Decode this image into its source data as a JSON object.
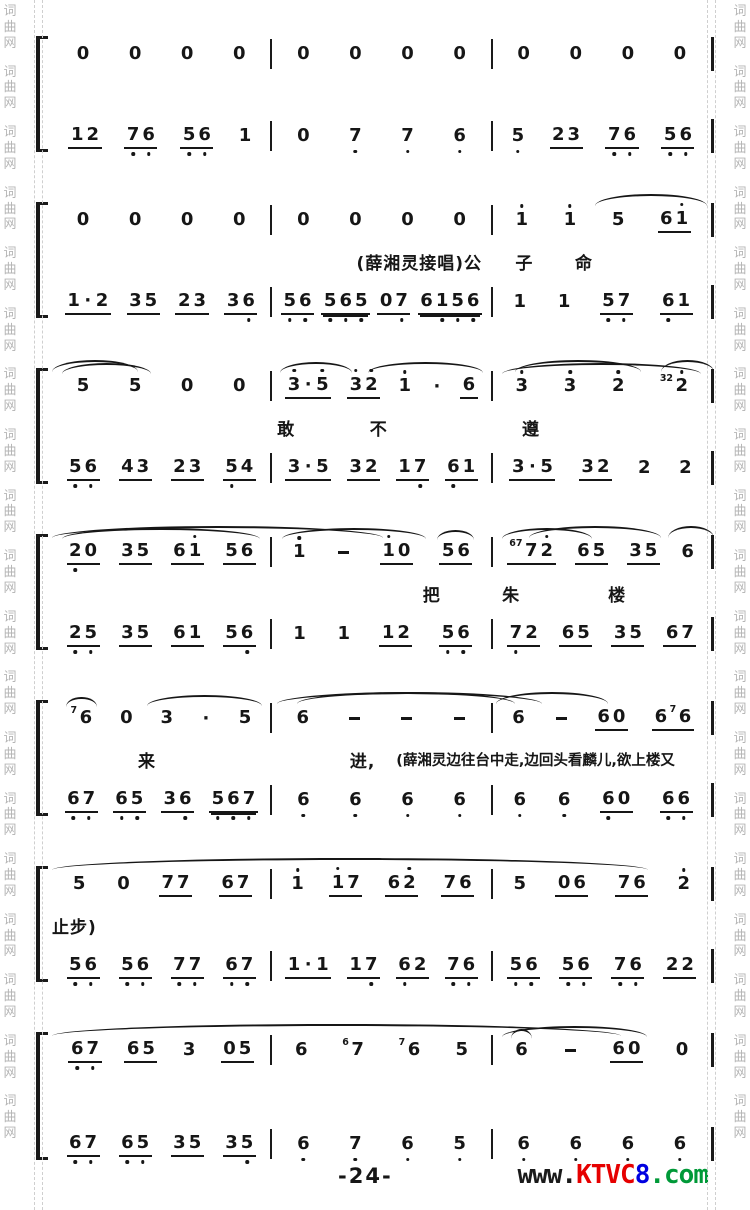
{
  "watermark": {
    "chars": [
      "词",
      "曲",
      "网"
    ],
    "color": "#b5b5b5"
  },
  "footer": {
    "page_number": "-24-",
    "logo_prefix": "www.",
    "logo_brand": "KTVC",
    "logo_digit": "8",
    "logo_suffix": ".com",
    "logo_colors": {
      "prefix": "#1a1a1a",
      "brand": "#e60000",
      "digit": "#0000e0",
      "suffix": "#009938"
    }
  },
  "score": {
    "ink": "#161616",
    "systems": [
      {
        "upper": {
          "ms": [
            {
              "u": [
                "0",
                "0",
                "0",
                "0"
              ]
            },
            {
              "u": [
                "0",
                "0",
                "0",
                "0"
              ]
            },
            {
              "u": [
                "0",
                "0",
                "0",
                "0"
              ]
            }
          ]
        },
        "lyrics": [],
        "lower": {
          "ms": [
            {
              "u": [
                "12/1",
                "7,6,/1",
                "5,6,/1",
                "1"
              ]
            },
            {
              "u": [
                "0",
                "7,",
                "7,",
                "6,"
              ]
            },
            {
              "u": [
                "5,",
                "23/1",
                "7,6,/1",
                "5,6,/1"
              ]
            }
          ]
        }
      },
      {
        "upper": {
          "arcs": [
            {
              "l": "82%",
              "w": "17%"
            }
          ],
          "ms": [
            {
              "u": [
                "0",
                "0",
                "0",
                "0"
              ]
            },
            {
              "u": [
                "0",
                "0",
                "0",
                "0"
              ]
            },
            {
              "u": [
                "1'",
                "1'",
                "5",
                "61'/1"
              ]
            }
          ]
        },
        "lyrics": [
          {
            "t": "(薛湘灵接唱)公",
            "l": "46%"
          },
          {
            "t": "子",
            "l": "70%"
          },
          {
            "t": "命",
            "l": "79%"
          }
        ],
        "lower": {
          "ms": [
            {
              "u": [
                "1.2/1",
                "35/1",
                "23/1",
                "36,/1"
              ]
            },
            {
              "u": [
                "5,6,/1",
                "5,6,5,/2",
                "07,/1",
                "61,5,6,/2"
              ]
            },
            {
              "u": [
                "1",
                "1",
                "5,7,/1",
                "6,1/1"
              ]
            }
          ]
        }
      },
      {
        "upper": {
          "arcs": [
            {
              "l": "0%",
              "w": "13%"
            },
            {
              "l": "70%",
              "w": "19%"
            },
            {
              "l": "92%",
              "w": "8%"
            }
          ],
          "ms": [
            {
              "u": [
                "5",
                "5",
                "0",
                "0"
              ],
              "slurs": [
                [
                  0,
                  1
                ]
              ]
            },
            {
              "u": [
                "3'.5'/1",
                "3'2'/1",
                "1'",
                ".",
                "6/1"
              ],
              "slurs": [
                [
                  0,
                  1
                ],
                [
                  2,
                  4
                ]
              ]
            },
            {
              "u": [
                "3'",
                "3'",
                "2'",
                "(32)2'"
              ],
              "slurs": [
                [
                  0,
                  3
                ]
              ]
            }
          ]
        },
        "lyrics": [
          {
            "t": "敢",
            "l": "34%"
          },
          {
            "t": "不",
            "l": "48%"
          },
          {
            "t": "遵",
            "l": "71%"
          }
        ],
        "lower": {
          "ms": [
            {
              "u": [
                "5,6,/1",
                "43/1",
                "23/1",
                "5,4/1"
              ]
            },
            {
              "u": [
                "3.5/1",
                "32/1",
                "17,/1",
                "6,1/1"
              ]
            },
            {
              "u": [
                "3.5/1",
                "32/1",
                "2",
                "2"
              ]
            }
          ]
        }
      },
      {
        "upper": {
          "arcs": [
            {
              "l": "0%",
              "w": "50%"
            },
            {
              "l": "72%",
              "w": "20%"
            },
            {
              "l": "93%",
              "w": "7%"
            }
          ],
          "ms": [
            {
              "u": [
                "2,0/1",
                "35/1",
                "61'/1",
                "56/1"
              ],
              "slurs": [
                [
                  0,
                  3
                ]
              ]
            },
            {
              "u": [
                "1'",
                "-",
                "1'0/1",
                "~56/1"
              ],
              "slurs": [
                [
                  0,
                  2
                ]
              ]
            },
            {
              "u": [
                "(67)72'/1",
                "65/1",
                "35/1",
                "6"
              ],
              "slurs": [
                [
                  0,
                  1
                ]
              ]
            }
          ]
        },
        "lyrics": [
          {
            "t": "把",
            "l": "56%"
          },
          {
            "t": "朱",
            "l": "68%"
          },
          {
            "t": "楼",
            "l": "84%"
          }
        ],
        "lower": {
          "ms": [
            {
              "u": [
                "2,5,/1",
                "35/1",
                "61/1",
                "56,/1"
              ]
            },
            {
              "u": [
                "1",
                "1",
                "12/1",
                "5,6,/1"
              ]
            },
            {
              "u": [
                "7,2/1",
                "65/1",
                "35/1",
                "67/1"
              ]
            }
          ]
        }
      },
      {
        "upper": {
          "arcs": [
            {
              "l": "34%",
              "w": "40%"
            },
            {
              "l": "37%",
              "w": "33%"
            },
            {
              "l": "67%",
              "w": "17%"
            }
          ],
          "ms": [
            {
              "u": [
                "~(7)6",
                "0",
                "3",
                ".",
                "5"
              ],
              "slurs": [
                [
                  2,
                  4
                ]
              ]
            },
            {
              "u": [
                "6",
                "-",
                "-",
                "-"
              ]
            },
            {
              "u": [
                "6",
                "-",
                "60/1",
                "6(7)6/1"
              ]
            }
          ]
        },
        "lyrics": [
          {
            "t": "来",
            "l": "13%"
          },
          {
            "t": "进,",
            "l": "45%"
          },
          {
            "t": "(薛湘灵边往台中走,边回头看麟儿,欲上楼又",
            "l": "52%",
            "s": 1
          }
        ],
        "lower": {
          "ms": [
            {
              "u": [
                "6,7,/1",
                "6,5,/1",
                "36,/1",
                "5,6,7,/2"
              ]
            },
            {
              "u": [
                "6,",
                "6,",
                "6,",
                "6,"
              ]
            },
            {
              "u": [
                "6,",
                "6,",
                "6,0/1",
                "6,6,/1"
              ]
            }
          ]
        }
      },
      {
        "upper": {
          "arcs": [
            {
              "l": "0%",
              "w": "90%"
            }
          ],
          "ms": [
            {
              "u": [
                "5",
                "0",
                "77/1",
                "67/1"
              ]
            },
            {
              "u": [
                "1'",
                "1'7/1",
                "62'/1",
                "76/1"
              ]
            },
            {
              "u": [
                "5",
                "06/1",
                "76/1",
                "2'"
              ]
            }
          ]
        },
        "lyrics": [
          {
            "t": "止步)",
            "l": "0%"
          }
        ],
        "lower": {
          "ms": [
            {
              "u": [
                "5,6,/1",
                "5,6,/1",
                "7,7,/1",
                "6,7,/1"
              ]
            },
            {
              "u": [
                "1.1/1",
                "17,/1",
                "6,2/1",
                "7,6,/1"
              ]
            },
            {
              "u": [
                "5,6,/1",
                "5,6,/1",
                "7,6,/1",
                "22/1"
              ]
            }
          ]
        }
      },
      {
        "upper": {
          "arcs": [
            {
              "l": "0%",
              "w": "86%"
            }
          ],
          "ms": [
            {
              "u": [
                "6,7,/1",
                "65/1",
                "3",
                "05/1"
              ]
            },
            {
              "u": [
                "6",
                "(6)7",
                "(7)6",
                "5"
              ]
            },
            {
              "u": [
                "~6",
                "-",
                "60/1",
                "0"
              ],
              "slurs": [
                [
                  0,
                  2
                ]
              ]
            }
          ]
        },
        "lyrics": [],
        "tall": true,
        "lower": {
          "ms": [
            {
              "u": [
                "6,7,/1",
                "6,5,/1",
                "35/1",
                "35,/1"
              ]
            },
            {
              "u": [
                "6,",
                "7,",
                "6,",
                "5,"
              ]
            },
            {
              "u": [
                "6,",
                "6,",
                "6,",
                "6,"
              ]
            }
          ]
        }
      }
    ]
  }
}
